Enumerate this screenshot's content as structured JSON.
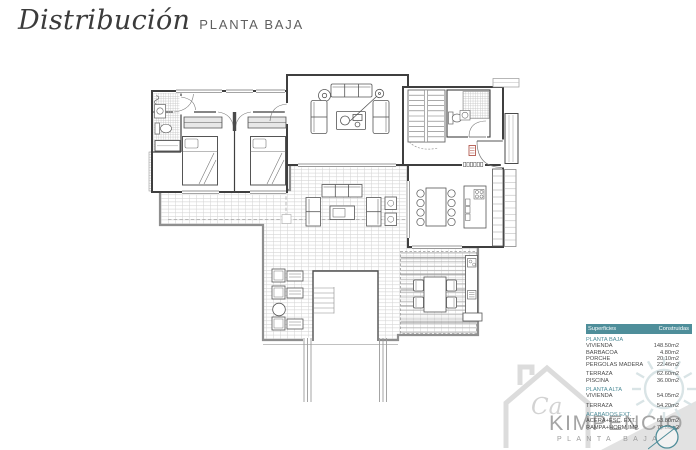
{
  "header": {
    "title_script": "Distribución",
    "title_caps": "PLANTA BAJA"
  },
  "areas_table": {
    "col_headers": {
      "left": "Superficies",
      "right": "Construidas"
    },
    "sections": [
      {
        "label": "PLANTA BAJA",
        "rows": [
          {
            "name": "VIVIENDA",
            "value": "148.50m2"
          },
          {
            "name": "BARBACOA",
            "value": "4.80m2"
          },
          {
            "name": "PORCHE",
            "value": "20.10m2"
          },
          {
            "name": "PERGOLAS MADERA",
            "value": "22.46m2"
          }
        ]
      },
      {
        "label": "",
        "rows": [
          {
            "name": "TERRAZA",
            "value": "62.60m2"
          },
          {
            "name": "PISCINA",
            "value": "36.00m2"
          }
        ]
      },
      {
        "label": "PLANTA ALTA",
        "rows": [
          {
            "name": "VIVIENDA",
            "value": "54.05m2"
          }
        ]
      },
      {
        "label": "",
        "rows": [
          {
            "name": "TERRAZA",
            "value": "54.20m2"
          }
        ]
      },
      {
        "label": "ACABADOS EXT.",
        "rows": [
          {
            "name": "ACERA+ESC. EXT.",
            "value": "63.80m2"
          },
          {
            "name": "RAMPA+HORM.IMP.",
            "value": "70.80m2"
          }
        ]
      }
    ]
  },
  "watermark": {
    "script": "Ca",
    "brand": "KIMPENCIO",
    "subtitle": "PLANTA BAJA"
  },
  "colors": {
    "accent_teal": "#4e8e9a",
    "wall_gray": "#3f3f3f",
    "terrace_edge": "#8f8f8f",
    "watermark_gray": "#a5a5a5",
    "radiator_red": "#a94438"
  }
}
